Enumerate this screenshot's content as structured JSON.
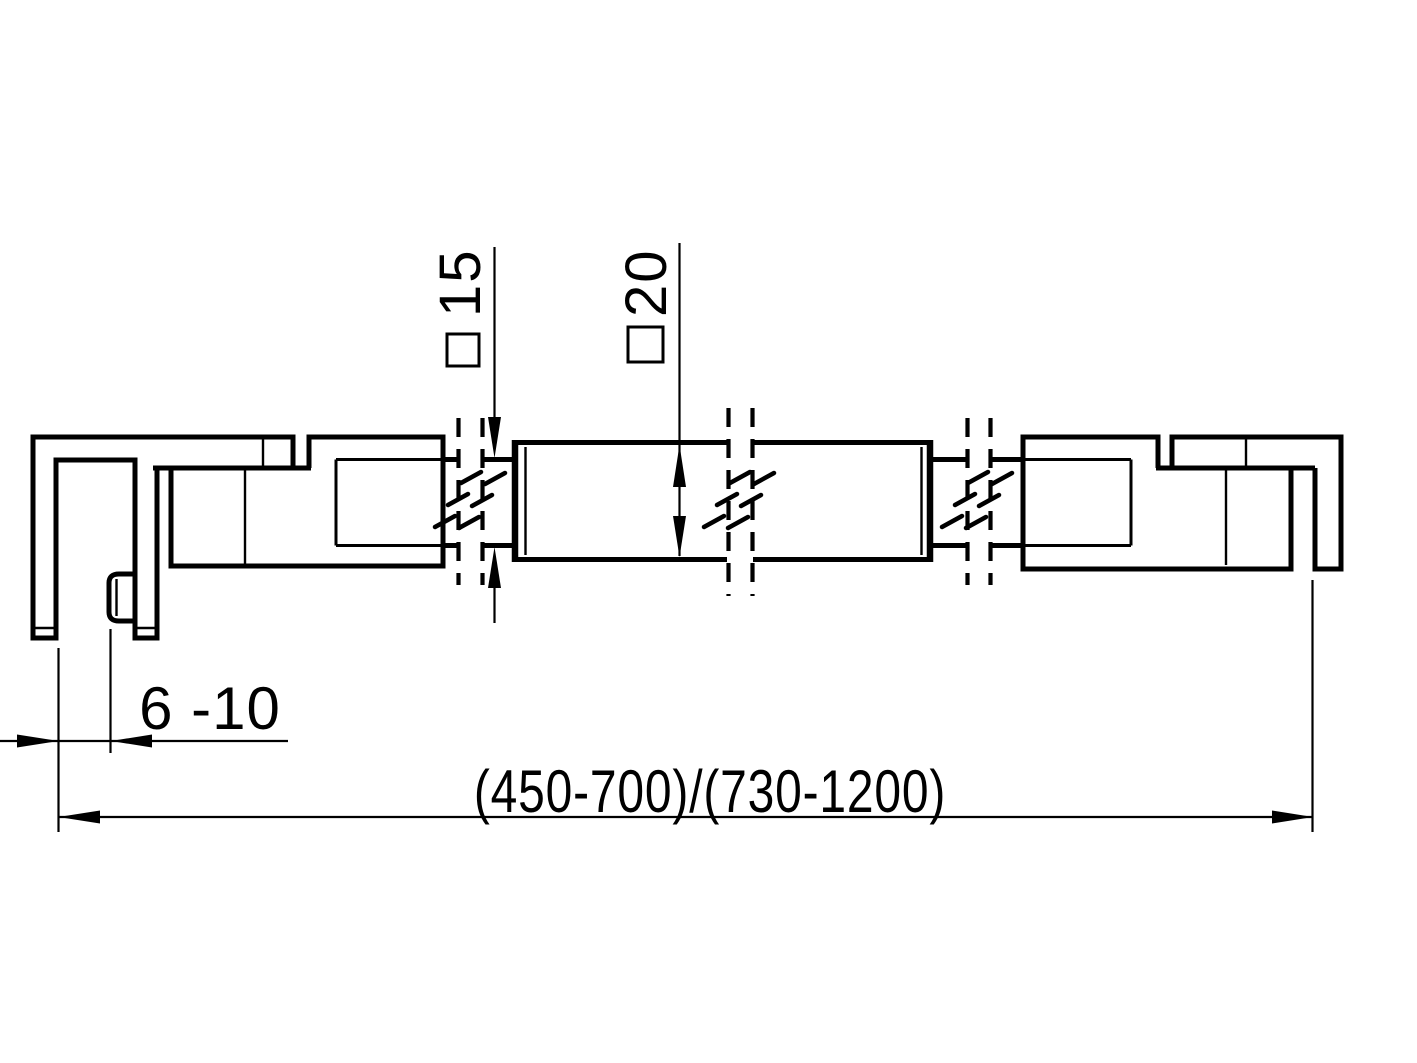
{
  "drawing": {
    "type": "technical-section-drawing",
    "subject": "glass shower stabilizer bar with two glass clamps",
    "dimensions": {
      "rod_section": {
        "symbol": "square",
        "value": "15"
      },
      "bar_section": {
        "symbol": "square",
        "value": "20"
      },
      "glass_thickness": {
        "value": "6 -10"
      },
      "overall_length": {
        "value": "(450-700)/(730-1200)"
      }
    },
    "colors": {
      "line": "#000000",
      "background": "#ffffff"
    }
  }
}
